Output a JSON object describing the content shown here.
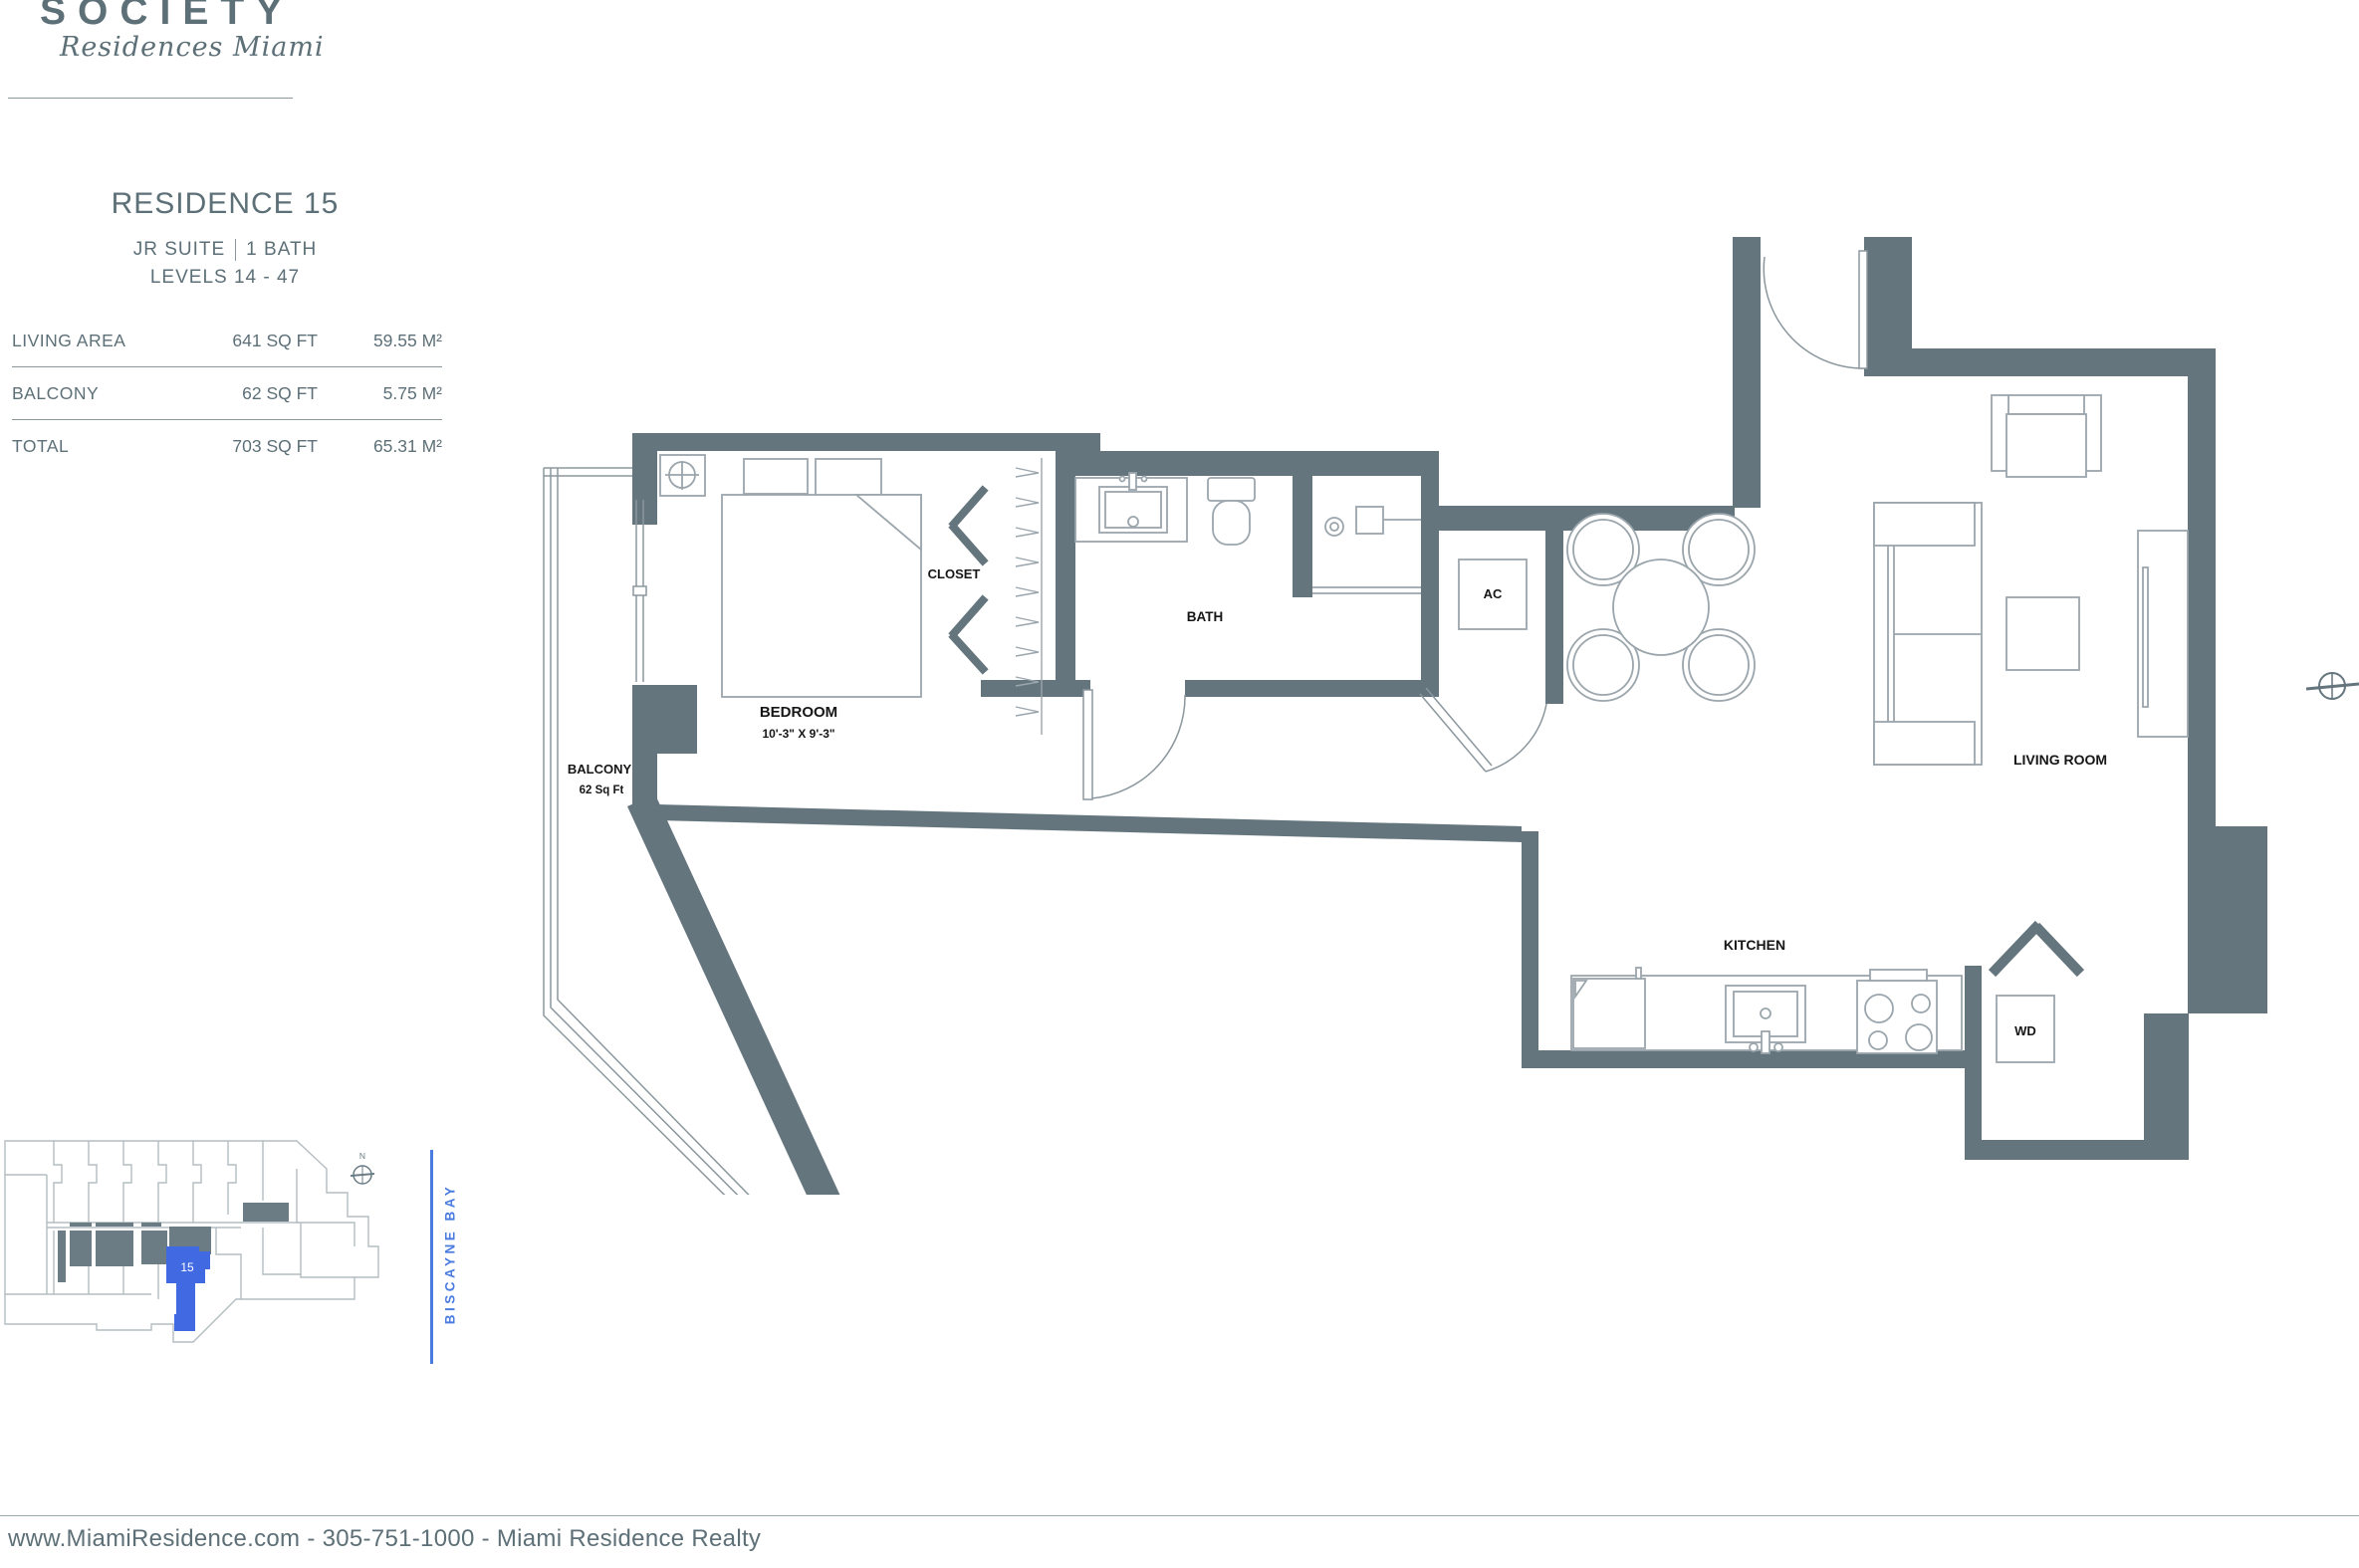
{
  "brand": {
    "name": "SOCIETY",
    "tagline": "Residences Miami"
  },
  "residence": {
    "title": "RESIDENCE 15",
    "suite": "JR SUITE",
    "bath": "1 BATH",
    "levels": "LEVELS 14 - 47"
  },
  "area_table": {
    "rows": [
      {
        "label": "LIVING AREA",
        "sqft": "641 SQ FT",
        "metric": "59.55 M²"
      },
      {
        "label": "BALCONY",
        "sqft": "62 SQ FT",
        "metric": "5.75 M²"
      },
      {
        "label": "TOTAL",
        "sqft": "703 SQ FT",
        "metric": "65.31 M²"
      }
    ]
  },
  "floor_plan": {
    "labels": {
      "bedroom": "BEDROOM",
      "bedroom_dim": "10'-3\" X 9'-3\"",
      "closet": "CLOSET",
      "bath": "BATH",
      "ac": "AC",
      "balcony": "BALCONY",
      "balcony_area": "62 Sq Ft",
      "living_room": "LIVING ROOM",
      "kitchen": "KITCHEN",
      "washer_dryer": "WD",
      "north": "N"
    }
  },
  "keyplan": {
    "unit_number": "15",
    "water_label": "BISCAYNE BAY",
    "north": "N"
  },
  "footer": {
    "text": "www.MiamiResidence.com  -  305-751-1000  -  Miami Residence Realty"
  },
  "colors": {
    "slate_text": "#5d7078",
    "wall": "#64757e",
    "unit_highlight": "#4169e1",
    "bay_blue": "#4a7ce0"
  }
}
